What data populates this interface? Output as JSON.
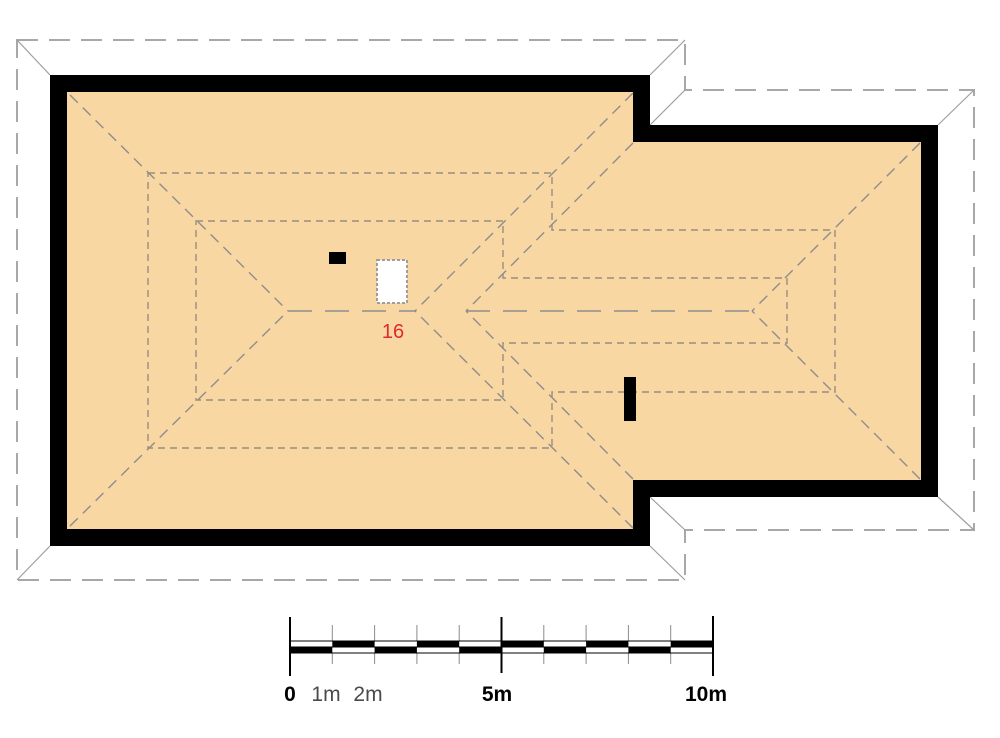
{
  "title": "Roof plan with scale bar",
  "colors": {
    "background": "#ffffff",
    "roof_fill": "#f9d7a3",
    "wall": "#000000",
    "roof_line": "#8d8d8d",
    "contour_line": "#998e7f",
    "overhang_line": "#a8a8a8",
    "corner_tick": "#9e9e9e",
    "chimney_fill": "#000000",
    "skylight_fill": "#ffffff",
    "skylight_border": "#9e9e9e",
    "label_red": "#e02a30",
    "scale_minor_text": "#4a4a4a",
    "scale_minor_tick": "#8a8a8a",
    "scale_major_tick": "#000000"
  },
  "plan": {
    "overhang_points": "17,40 685,40 685,90 974,90 974,530 685,530 685,580 17,580",
    "wall_outer_points": "50,75 650,75 650,125 938,125 938,497 650,497 650,546 50,546",
    "wall_inner_points": "67,92 633,92 633,142 921,142 921,480 633,480 633,529 67,529",
    "corner_ticks": [
      [
        17,
        40,
        50,
        75
      ],
      [
        685,
        40,
        650,
        75
      ],
      [
        685,
        90,
        650,
        125
      ],
      [
        974,
        90,
        938,
        125
      ],
      [
        974,
        530,
        938,
        497
      ],
      [
        685,
        530,
        650,
        497
      ],
      [
        685,
        580,
        650,
        546
      ],
      [
        17,
        580,
        50,
        546
      ]
    ],
    "ridge_lines": [
      [
        288,
        311,
        415,
        311
      ],
      [
        466,
        311,
        752,
        311
      ]
    ],
    "hip_valley_lines": [
      [
        70,
        95,
        288,
        311
      ],
      [
        70,
        526,
        288,
        311
      ],
      [
        633,
        93,
        415,
        311
      ],
      [
        633,
        528,
        415,
        311
      ],
      [
        633,
        143,
        466,
        311
      ],
      [
        633,
        479,
        466,
        311
      ],
      [
        920,
        143,
        752,
        311
      ],
      [
        920,
        479,
        752,
        311
      ]
    ],
    "contour_loops": [
      "148,173 552,173 552,230 835,230 835,392 552,392 552,448 148,448",
      "196,221 503,221 503,278 787,278 787,343 503,343 503,400 196,400"
    ],
    "chimneys": [
      {
        "x": 329,
        "y": 252,
        "w": 17,
        "h": 12
      },
      {
        "x": 624,
        "y": 377,
        "w": 12,
        "h": 44
      }
    ],
    "skylight": {
      "x": 377,
      "y": 260,
      "w": 30,
      "h": 43
    },
    "area_label": {
      "text": "16"
    }
  },
  "scale_bar": {
    "x0": 290,
    "x10": 713,
    "y_top": 641,
    "y_mid": 647,
    "y_bot": 653,
    "top_black_meters": [
      [
        1,
        2
      ],
      [
        3,
        4
      ],
      [
        5,
        6
      ],
      [
        7,
        8
      ],
      [
        9,
        10
      ]
    ],
    "bottom_black_meters": [
      [
        0,
        1
      ],
      [
        2,
        3
      ],
      [
        4,
        5
      ],
      [
        6,
        7
      ],
      [
        8,
        9
      ]
    ],
    "major_ticks": [
      {
        "m": 0,
        "y1": 617,
        "y2": 676
      },
      {
        "m": 5,
        "y1": 617,
        "y2": 673
      },
      {
        "m": 10,
        "y1": 616,
        "y2": 676
      }
    ],
    "minor_tick_meters": [
      1,
      2,
      3,
      4,
      6,
      7,
      8,
      9
    ],
    "minor_y1": 625,
    "minor_y2": 664,
    "labels": [
      {
        "text": "0"
      },
      {
        "text": "1m"
      },
      {
        "text": "2m"
      },
      {
        "text": "5m"
      },
      {
        "text": "10m"
      }
    ]
  }
}
